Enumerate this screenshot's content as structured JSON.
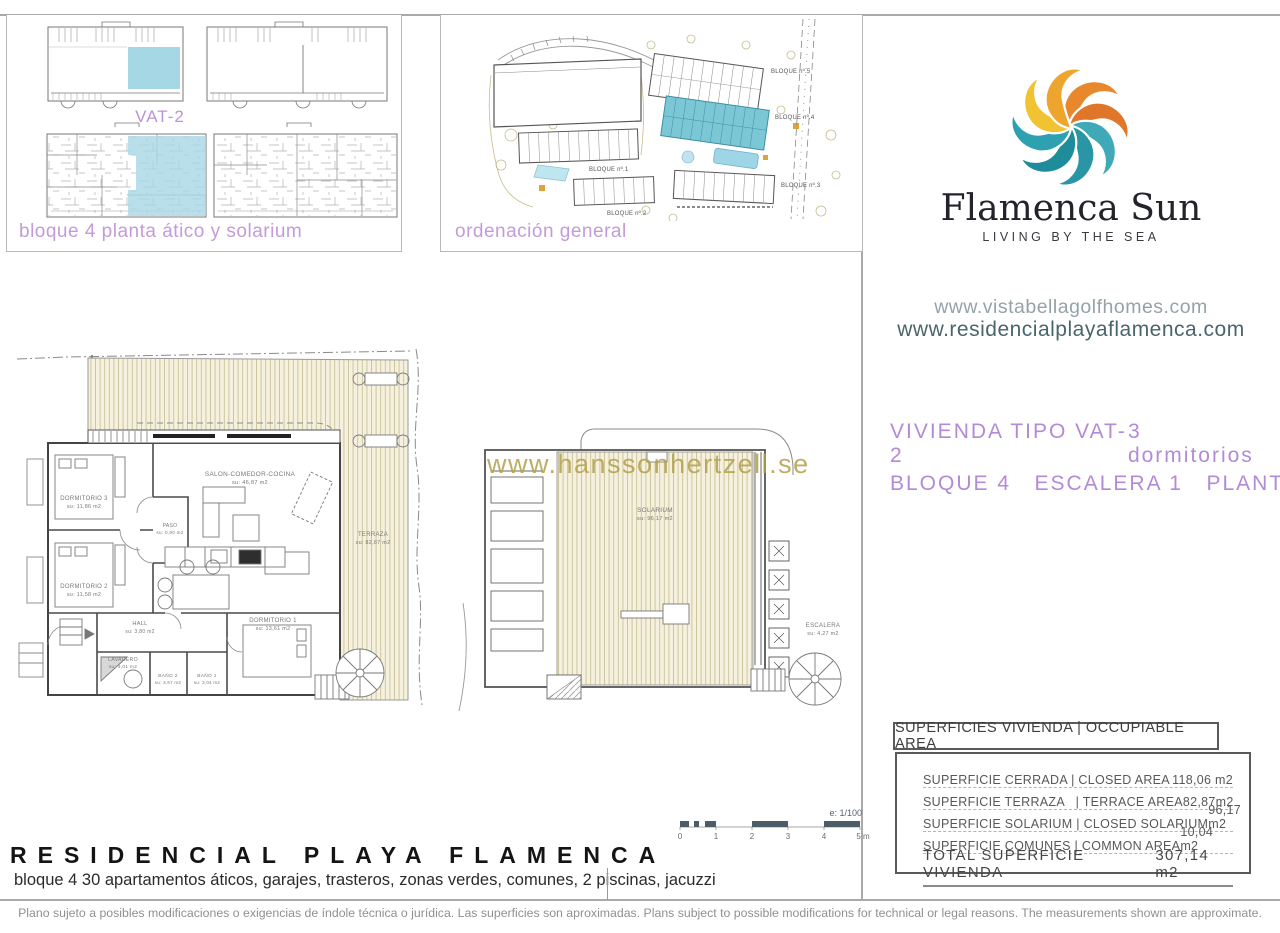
{
  "thumbs": {
    "vat_label": "VAT-2",
    "caption": "bloque 4 planta ático y solarium"
  },
  "siteplan": {
    "caption": "ordenación general",
    "blocks": [
      "BLOQUE nº.5",
      "BLOQUE nº.4",
      "BLOQUE nº.3",
      "BLOQUE nº.1",
      "BLOQUE nº.2"
    ]
  },
  "brand": {
    "name": "Flamenca Sun",
    "tagline": "LIVING BY THE SEA",
    "url_primary": "www.vistabellagolfhomes.com",
    "url_secondary": "www.residencialplayaflamenca.com"
  },
  "unit": {
    "type": "VIVIENDA TIPO VAT-2",
    "bedrooms": "3 dormitorios",
    "location": "BLOQUE 4   ESCALERA 1   PLANTA ÁTICO"
  },
  "plan": {
    "watermark": "www.hanssonhertzell.se",
    "scale_label": "e: 1/100",
    "scale_ticks": [
      "0",
      "1",
      "2",
      "3",
      "4",
      "5 m"
    ],
    "rooms": [
      {
        "name": "SALON-COMEDOR-COCINA",
        "area": "su: 46,87 m2"
      },
      {
        "name": "DORMITORIO 3",
        "area": "su: 11,86 m2"
      },
      {
        "name": "DORMITORIO 2",
        "area": "su: 11,58 m2"
      },
      {
        "name": "PASO",
        "area": "su: 0,90 m2"
      },
      {
        "name": "HALL",
        "area": "su: 3,80 m2"
      },
      {
        "name": "LAVADERO",
        "area": "su: 3,01 m2"
      },
      {
        "name": "BAÑO 2",
        "area": "su: 3,67 m2"
      },
      {
        "name": "BAÑO 1",
        "area": "su: 3,04 m2"
      },
      {
        "name": "DORMITORIO 1",
        "area": "su: 13,61 m2"
      },
      {
        "name": "TERRAZA",
        "area": "su: 82,87 m2"
      },
      {
        "name": "SOLARIUM",
        "area": "su: 96,17 m2"
      },
      {
        "name": "ESCALERA",
        "area": "su: 4,27 m2"
      }
    ]
  },
  "areas_table": {
    "header": "SUPERFICIES VIVIENDA | OCCUPIABLE AREA",
    "rows": [
      {
        "label": "SUPERFICIE CERRADA | CLOSED AREA",
        "value": "118,06 m2"
      },
      {
        "label": "SUPERFICIE TERRAZA   | TERRACE AREA",
        "value": "82,87m2"
      },
      {
        "label": "SUPERFICIE SOLARIUM | CLOSED SOLARIUM",
        "value": "96,17 m2"
      },
      {
        "label": "SUPERFICIE COMUNES | COMMON AREA",
        "value": "10,04 m2"
      }
    ],
    "total_label": "TOTAL SUPERFICIE VIVIENDA",
    "total_value": "307,14 m2"
  },
  "footer": {
    "title": "RESIDENCIAL PLAYA FLAMENCA",
    "subtitle": "bloque 4 30 apartamentos áticos, garajes, trasteros, zonas verdes, comunes, 2 piscinas, jacuzzi",
    "disclaimer": "Plano sujeto a posibles modificaciones o exigencias de índole técnica o jurídica. Las superficies son aproximadas. Plans subject to possible modifications for technical or legal reasons. The measurements shown are approximate."
  },
  "colors": {
    "accent_purple": "#b78fd6",
    "accent_teal": "#4e6a72",
    "highlight_blue": "#a5d7e4",
    "watermark_gold": "#b3a04b"
  }
}
